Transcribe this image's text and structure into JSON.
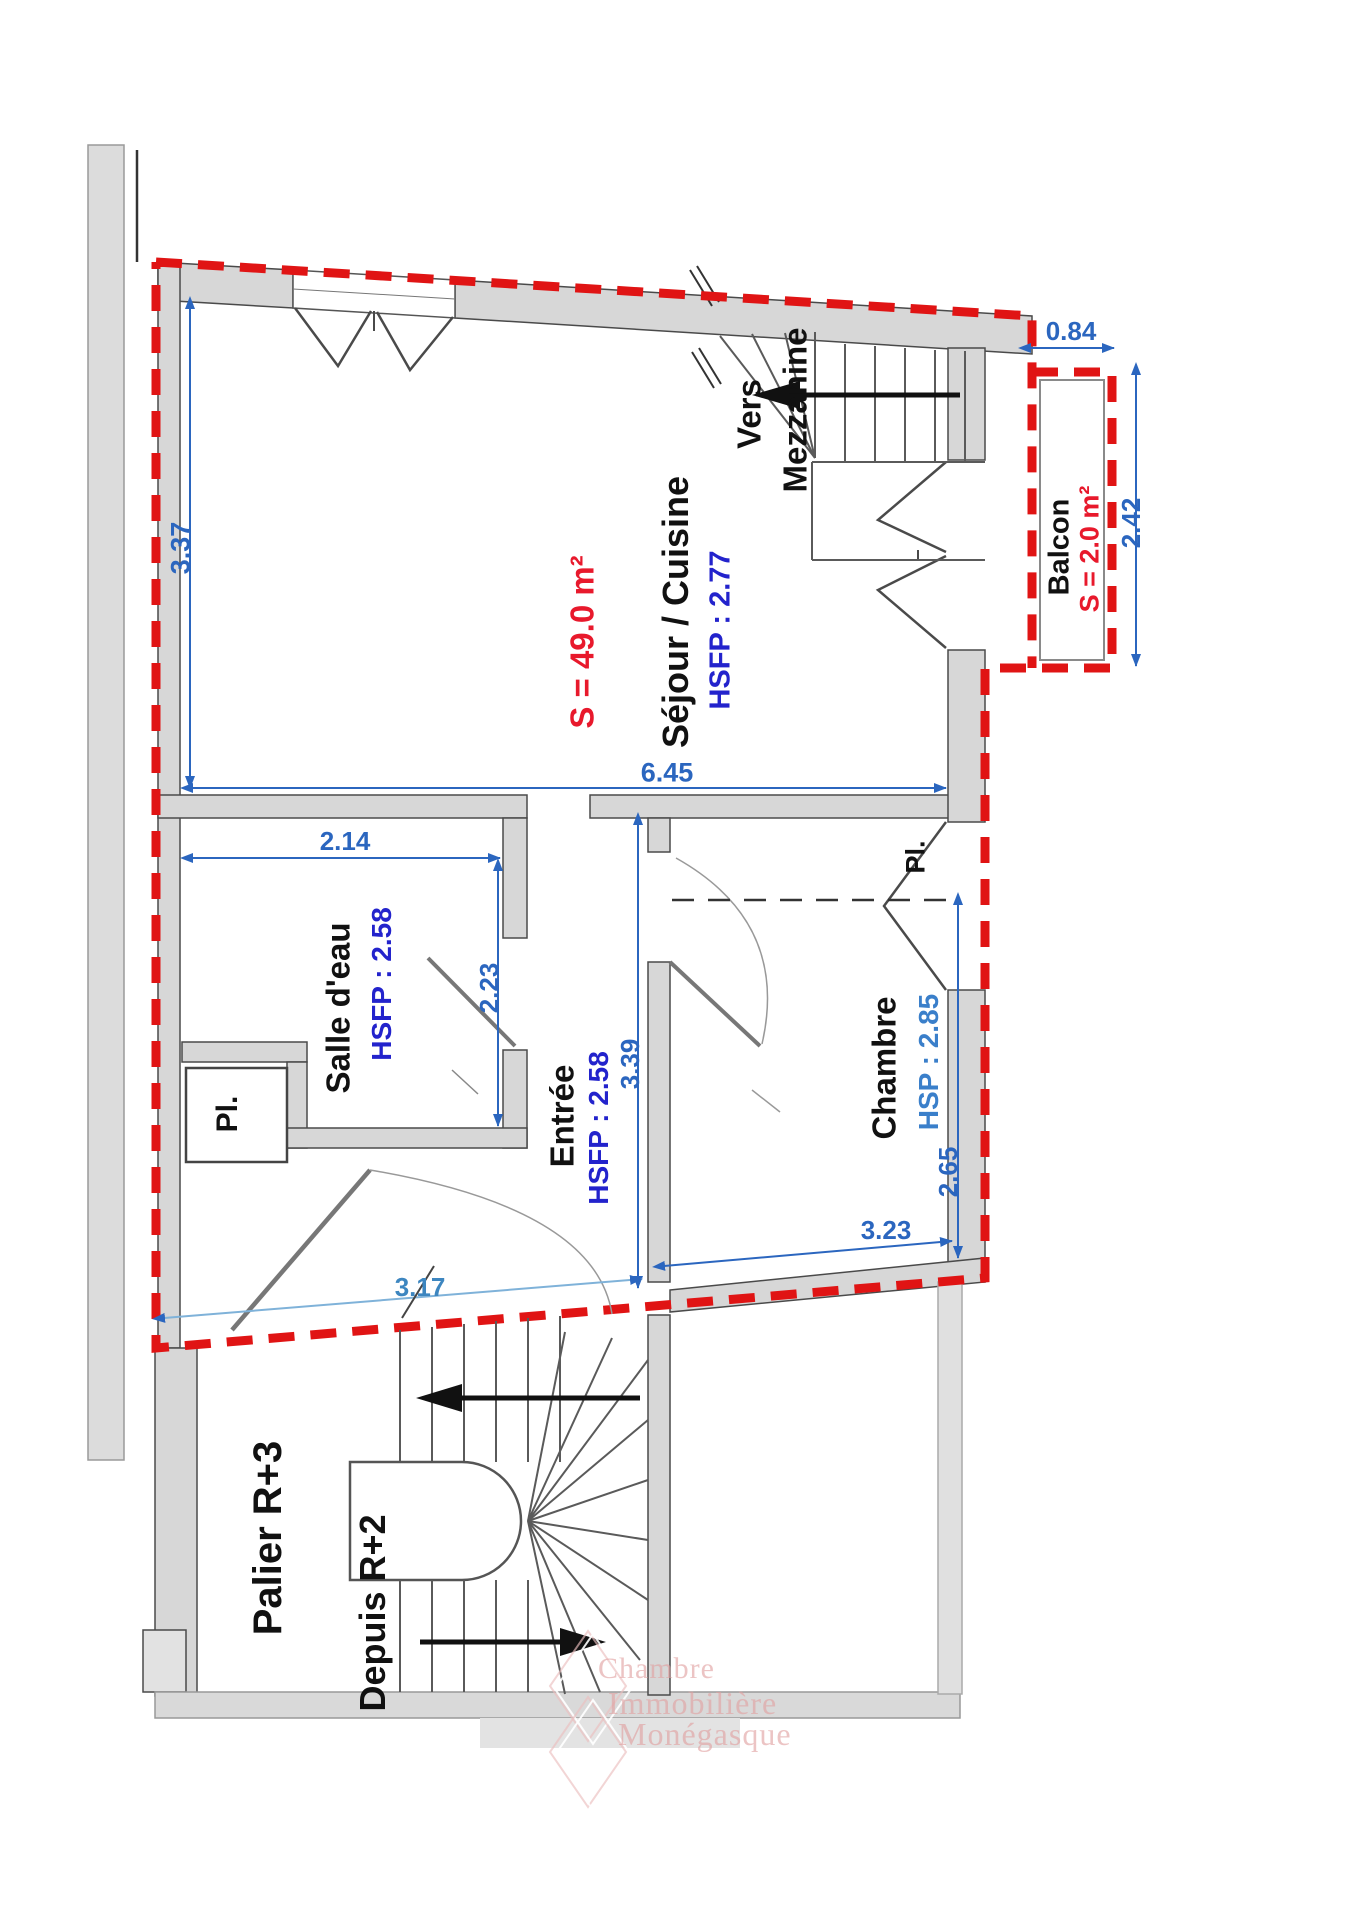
{
  "plan": {
    "rooms": {
      "sejour": {
        "name": "Séjour / Cuisine",
        "ceiling": "HSFP : 2.77",
        "area": "S = 49.0 m²"
      },
      "balcon": {
        "name": "Balcon",
        "area": "S = 2.0 m²"
      },
      "salle_eau": {
        "name": "Salle d'eau",
        "ceiling": "HSFP : 2.58"
      },
      "entree": {
        "name": "Entrée",
        "ceiling": "HSFP : 2.58"
      },
      "chambre": {
        "name": "Chambre",
        "ceiling": "HSP : 2.85"
      },
      "closet_salle_eau": {
        "name": "Pl."
      },
      "closet_chambre": {
        "name": "Pl."
      }
    },
    "stairs": {
      "vers": "Vers",
      "mezzanine": "Mezzanine",
      "palier": "Palier R+3",
      "depuis": "Depuis R+2"
    },
    "dimensions": {
      "sejour_depth": "3.37",
      "sejour_width": "6.45",
      "balcon_width": "0.84",
      "balcon_depth": "2.42",
      "salle_eau_width": "2.14",
      "salle_eau_depth": "2.23",
      "entree_depth": "3.39",
      "chambre_right_depth": "2.65",
      "chambre_width": "3.23",
      "entree_width": "3.17"
    },
    "colors": {
      "boundary_red": "#e01414",
      "dimension_blue": "#2b66bf",
      "ceiling_blue": "#2323cc",
      "area_red": "#e8192c",
      "wall_gray": "#d7d7d7"
    },
    "watermark": {
      "line1": "Chambre",
      "line2": "Immobilière",
      "line3": "Monégasque"
    }
  }
}
